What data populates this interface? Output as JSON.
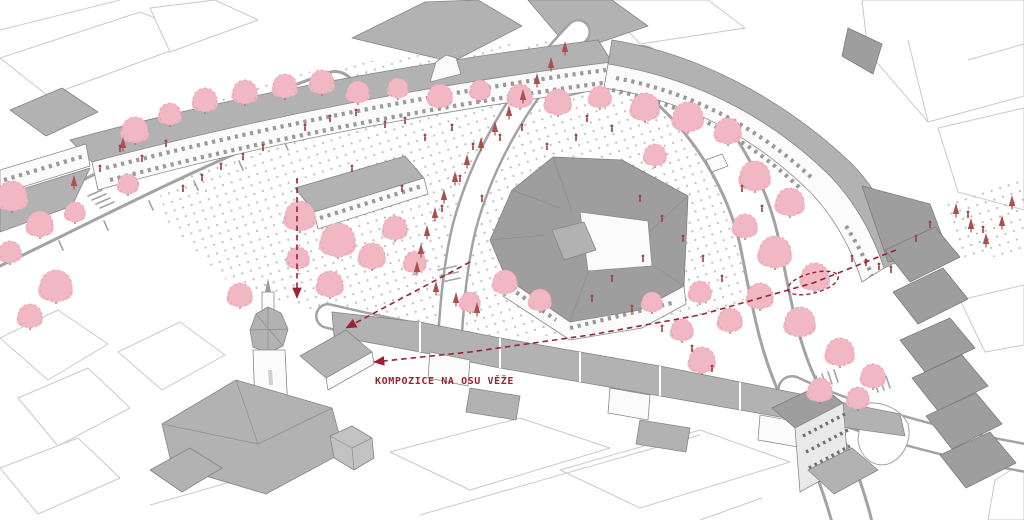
{
  "annotation": {
    "label": "KOMPOZICE NA OSU VĚŽE",
    "color": "#9c2134"
  },
  "colors": {
    "background": "#ffffff",
    "context_line": "#c9c9c9",
    "wall": "#fbfbfb",
    "wall_stroke": "#8a8a8a",
    "roof": "#b2b2b2",
    "roof_dark": "#9e9e9e",
    "street_line": "#a3a3a3",
    "paving_dot": "#bdbdbd",
    "tree_fill": "#f1b7c3",
    "tree_edge": "#df9fb1",
    "tree_trunk": "#b4626e",
    "sapling": "#ad4f4f",
    "person": "#a04545",
    "annotation": "#9c2134"
  },
  "scene": {
    "trees": [
      [
        135,
        130,
        13
      ],
      [
        170,
        114,
        11
      ],
      [
        205,
        100,
        12
      ],
      [
        245,
        92,
        12
      ],
      [
        285,
        86,
        12
      ],
      [
        322,
        82,
        12
      ],
      [
        358,
        92,
        11
      ],
      [
        398,
        88,
        10
      ],
      [
        440,
        96,
        12
      ],
      [
        480,
        90,
        10
      ],
      [
        520,
        96,
        12
      ],
      [
        558,
        102,
        13
      ],
      [
        600,
        97,
        11
      ],
      [
        645,
        107,
        14
      ],
      [
        688,
        117,
        15
      ],
      [
        728,
        131,
        13
      ],
      [
        655,
        155,
        11
      ],
      [
        12,
        196,
        15
      ],
      [
        40,
        224,
        13
      ],
      [
        10,
        252,
        11
      ],
      [
        56,
        286,
        16
      ],
      [
        30,
        316,
        12
      ],
      [
        75,
        212,
        10
      ],
      [
        128,
        184,
        10
      ],
      [
        300,
        216,
        15
      ],
      [
        338,
        240,
        17
      ],
      [
        372,
        256,
        13
      ],
      [
        330,
        284,
        13
      ],
      [
        298,
        258,
        11
      ],
      [
        240,
        295,
        12
      ],
      [
        395,
        228,
        12
      ],
      [
        415,
        262,
        11
      ],
      [
        505,
        282,
        12
      ],
      [
        540,
        300,
        11
      ],
      [
        470,
        302,
        10
      ],
      [
        755,
        176,
        15
      ],
      [
        790,
        202,
        14
      ],
      [
        745,
        226,
        12
      ],
      [
        775,
        252,
        16
      ],
      [
        815,
        277,
        14
      ],
      [
        760,
        296,
        13
      ],
      [
        800,
        322,
        15
      ],
      [
        730,
        320,
        12
      ],
      [
        700,
        292,
        11
      ],
      [
        840,
        352,
        14
      ],
      [
        873,
        376,
        12
      ],
      [
        682,
        330,
        11
      ],
      [
        652,
        302,
        10
      ],
      [
        702,
        360,
        13
      ],
      [
        820,
        390,
        12
      ],
      [
        858,
        398,
        11
      ]
    ],
    "saplings": [
      [
        565,
        52
      ],
      [
        551,
        68
      ],
      [
        537,
        84
      ],
      [
        523,
        100
      ],
      [
        509,
        116
      ],
      [
        495,
        132
      ],
      [
        481,
        148
      ],
      [
        467,
        165
      ],
      [
        455,
        182
      ],
      [
        444,
        200
      ],
      [
        435,
        218
      ],
      [
        427,
        236
      ],
      [
        421,
        254
      ],
      [
        417,
        272
      ],
      [
        436,
        292
      ],
      [
        456,
        303
      ],
      [
        477,
        313
      ],
      [
        956,
        214
      ],
      [
        971,
        229
      ],
      [
        986,
        244
      ],
      [
        1002,
        226
      ],
      [
        1012,
        206
      ],
      [
        123,
        148
      ],
      [
        74,
        186
      ]
    ],
    "people": [
      [
        183,
        192
      ],
      [
        202,
        181
      ],
      [
        221,
        170
      ],
      [
        243,
        160
      ],
      [
        263,
        151
      ],
      [
        305,
        131
      ],
      [
        330,
        122
      ],
      [
        356,
        116
      ],
      [
        385,
        128
      ],
      [
        405,
        124
      ],
      [
        425,
        141
      ],
      [
        452,
        131
      ],
      [
        473,
        150
      ],
      [
        500,
        141
      ],
      [
        522,
        131
      ],
      [
        547,
        150
      ],
      [
        576,
        141
      ],
      [
        460,
        182
      ],
      [
        482,
        202
      ],
      [
        442,
        212
      ],
      [
        402,
        192
      ],
      [
        352,
        172
      ],
      [
        640,
        202
      ],
      [
        662,
        222
      ],
      [
        683,
        242
      ],
      [
        703,
        262
      ],
      [
        722,
        282
      ],
      [
        643,
        262
      ],
      [
        612,
        282
      ],
      [
        592,
        302
      ],
      [
        632,
        312
      ],
      [
        662,
        332
      ],
      [
        692,
        352
      ],
      [
        712,
        372
      ],
      [
        742,
        192
      ],
      [
        762,
        212
      ],
      [
        612,
        132
      ],
      [
        587,
        122
      ],
      [
        120,
        152
      ],
      [
        142,
        162
      ],
      [
        100,
        172
      ],
      [
        166,
        147
      ],
      [
        852,
        262
      ],
      [
        866,
        266
      ],
      [
        879,
        270
      ],
      [
        891,
        273
      ],
      [
        930,
        228
      ],
      [
        916,
        242
      ],
      [
        968,
        218
      ],
      [
        983,
        233
      ]
    ],
    "arrows": [
      {
        "id": "tower-axis-vertical",
        "points": [
          [
            297,
            178
          ],
          [
            297,
            298
          ]
        ]
      },
      {
        "id": "tower-axis-main",
        "points": [
          [
            896,
            250
          ],
          [
            813,
            283
          ],
          [
            700,
            315
          ],
          [
            590,
            335
          ],
          [
            470,
            352
          ],
          [
            374,
            362
          ]
        ]
      },
      {
        "id": "tower-axis-short",
        "points": [
          [
            470,
            262
          ],
          [
            346,
            328
          ]
        ]
      }
    ],
    "axis_ellipse": {
      "cx": 813,
      "cy": 283,
      "rx": 26,
      "ry": 10,
      "rotate": -15
    }
  }
}
